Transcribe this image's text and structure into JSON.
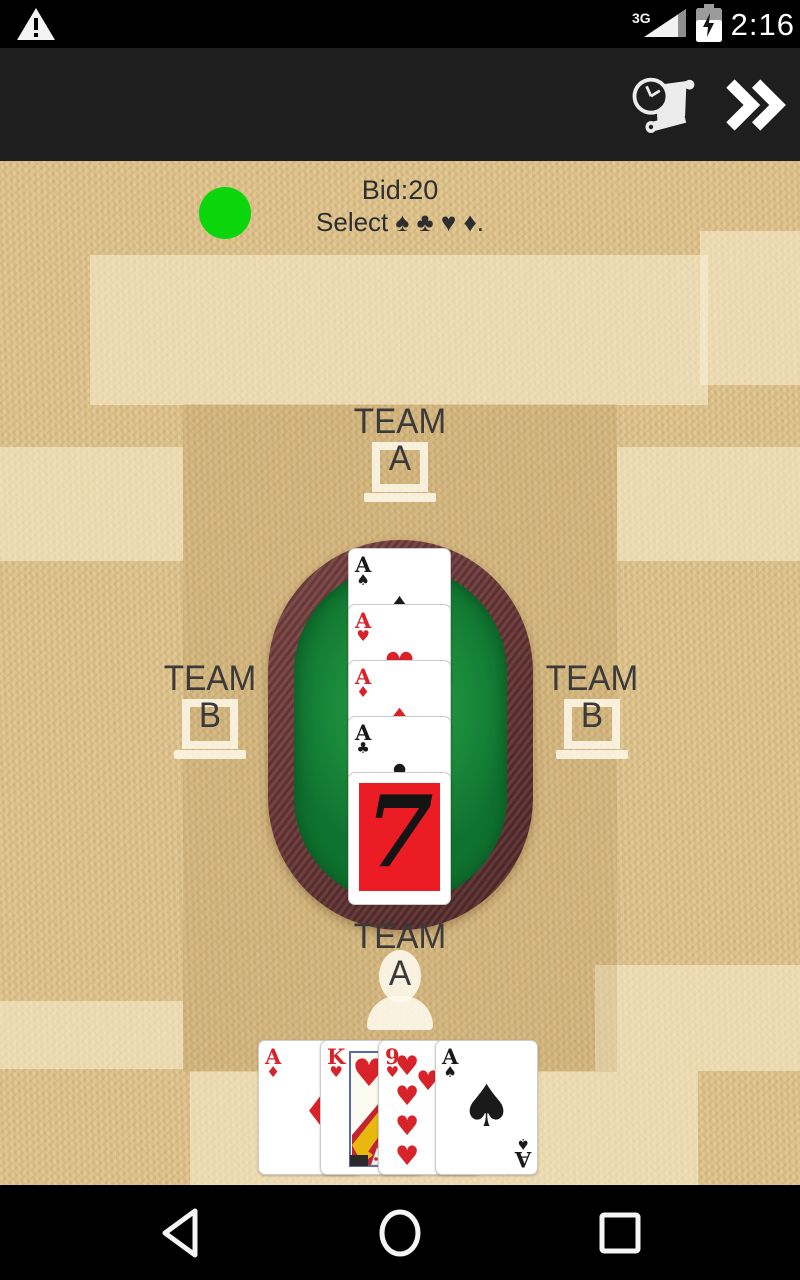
{
  "status_bar": {
    "time": "2:16",
    "network_type": "3G"
  },
  "game": {
    "bid_text": "Bid:20",
    "prompt_text": "Select ♠ ♣ ♥ ♦.",
    "seats": {
      "top": {
        "line1": "TEAM",
        "line2": "A"
      },
      "left": {
        "line1": "TEAM",
        "line2": "B"
      },
      "right": {
        "line1": "TEAM",
        "line2": "B"
      },
      "bottom": {
        "line1": "TEAM",
        "line2": "A"
      }
    },
    "table_cards": [
      {
        "rank": "A",
        "suit": "♠",
        "color": "#1a1a1a"
      },
      {
        "rank": "A",
        "suit": "♥",
        "color": "#d8232a"
      },
      {
        "rank": "A",
        "suit": "♦",
        "color": "#d8232a"
      },
      {
        "rank": "A",
        "suit": "♣",
        "color": "#1a1a1a"
      }
    ],
    "trump_card": {
      "rank": "7",
      "face_color": "#ec1c24",
      "digit_color": "#141414"
    },
    "hand_cards": [
      {
        "rank": "A",
        "suit": "♦",
        "color": "#d8232a"
      },
      {
        "rank": "K",
        "suit": "♥",
        "color": "#d8232a"
      },
      {
        "rank": "9",
        "suit": "♥",
        "color": "#d8232a"
      },
      {
        "rank": "A",
        "suit": "♠",
        "color": "#1a1a1a"
      }
    ],
    "colors": {
      "turn_dot": "#0bd60b",
      "felt_green": "#1b8a3a",
      "table_wood": "#6b3838",
      "background_tan": "#dcbf87"
    }
  }
}
